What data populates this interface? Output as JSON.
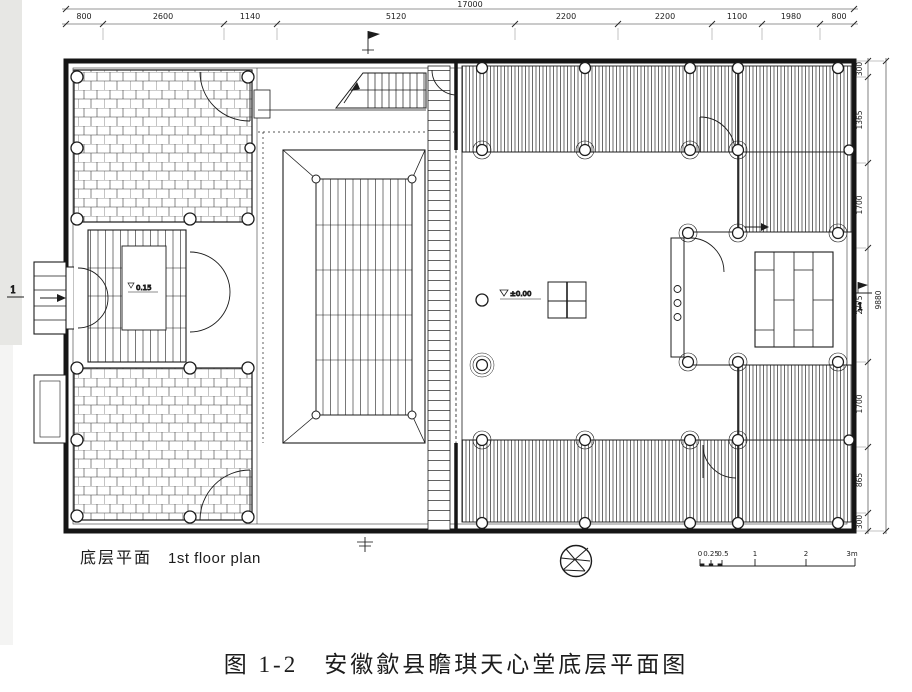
{
  "figure": {
    "plan_label_zh": "底层平面",
    "plan_label_en": "1st floor plan",
    "caption": "图 1-2　安徽歙县瞻琪天心堂底层平面图"
  },
  "dimensions": {
    "top": {
      "overall": "17000",
      "segments": [
        "800",
        "2600",
        "1140",
        "5120",
        "2200",
        "2200",
        "1100",
        "1980",
        "800"
      ]
    },
    "right": {
      "overall": "9880",
      "segments": [
        "300",
        "1365",
        "1700",
        "2775",
        "1700",
        "865",
        "300"
      ]
    }
  },
  "levels": {
    "courtyard": "±0.00",
    "west_room": "0.15"
  },
  "section_markers": {
    "left": "1",
    "right": "1"
  },
  "scale_bar": {
    "labels": [
      "0",
      "0.25",
      "0.5",
      "1",
      "2",
      "3m"
    ]
  },
  "icons": {
    "north_compass": "star-in-circle-north-arrow",
    "stair_arrow": "up-arrow",
    "entry_arrow": "right-arrow"
  },
  "colors": {
    "ink": "#1c1c1c",
    "paper": "#ffffff"
  }
}
